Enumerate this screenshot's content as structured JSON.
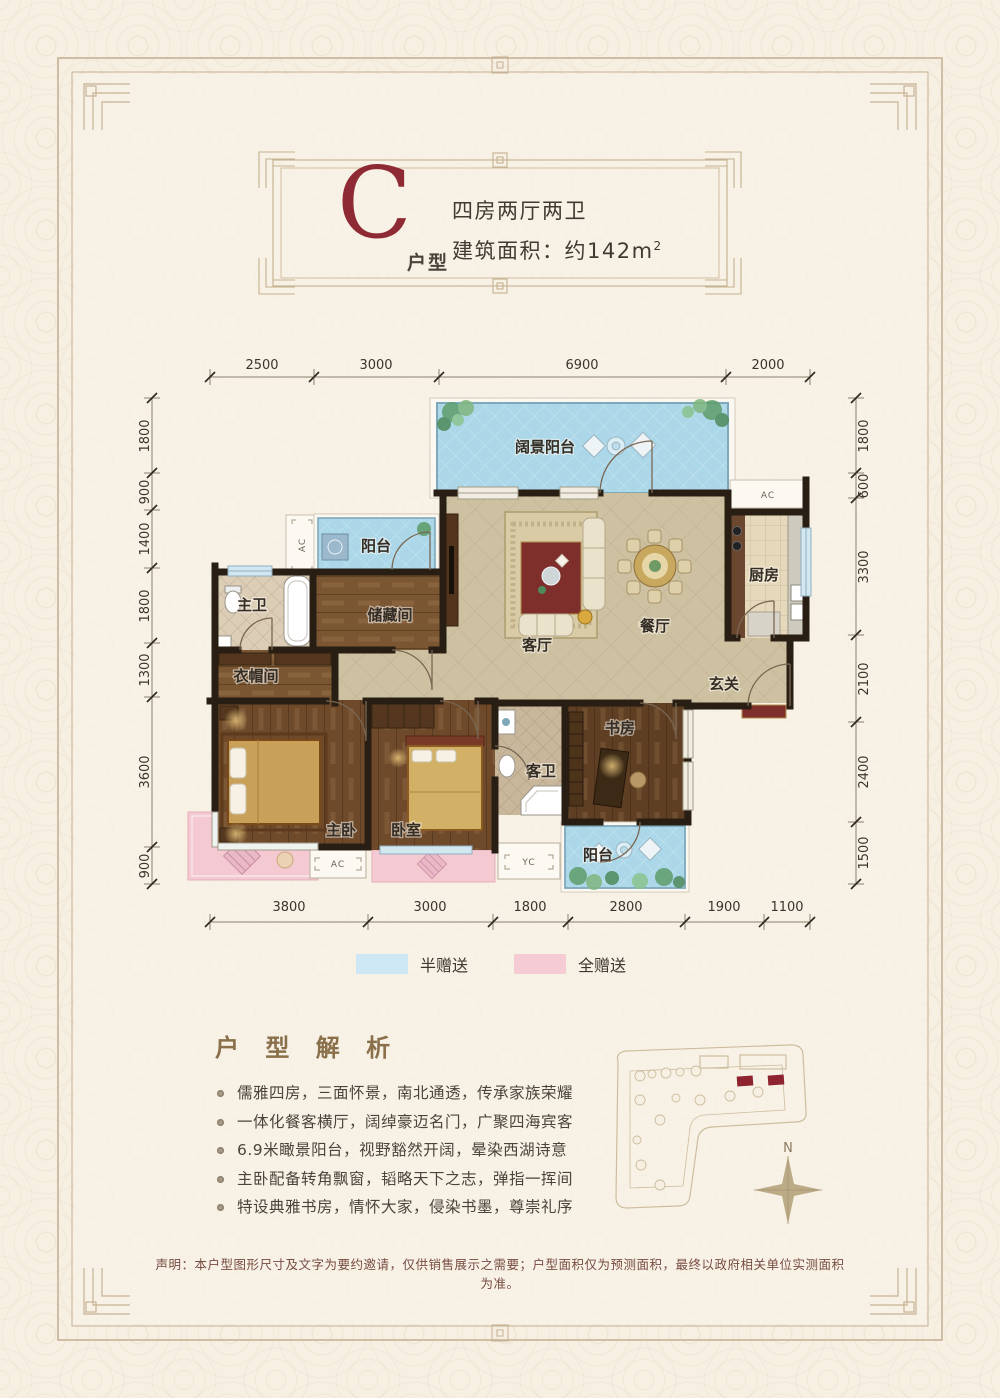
{
  "title": {
    "letter": "C",
    "letter_suffix": "户型",
    "line1": "四房两厅两卫",
    "line2": "建筑面积：约142m",
    "area_sup": "2"
  },
  "dims": {
    "top": [
      "2500",
      "3000",
      "6900",
      "2000"
    ],
    "bottom": [
      "3800",
      "3000",
      "1800",
      "2800",
      "1900",
      "1100"
    ],
    "left": [
      "1800",
      "900",
      "1400",
      "1800",
      "1300",
      "3600",
      "900"
    ],
    "right": [
      "1800",
      "600",
      "3300",
      "2100",
      "2400",
      "1500"
    ]
  },
  "rooms": {
    "view_balcony": "阔景阳台",
    "balcony_top": "阳台",
    "master_bath": "主卫",
    "storage": "储藏间",
    "cloakroom": "衣帽间",
    "living": "客厅",
    "dining": "餐厅",
    "kitchen": "厨房",
    "foyer": "玄关",
    "master_bedroom": "主卧",
    "bedroom": "卧室",
    "guest_bath": "客卫",
    "study": "书房",
    "balcony_bottom": "阳台"
  },
  "ac": [
    "AC",
    "AC",
    "AC",
    "YC"
  ],
  "legend": [
    {
      "label": "半赠送",
      "color": "#cde7f5"
    },
    {
      "label": "全赠送",
      "color": "#f6ccd4"
    }
  ],
  "analysis": {
    "heading": "户 型 解 析",
    "bullets": [
      "儒雅四房，三面怀景，南北通透，传承家族荣耀",
      "一体化餐客横厅，阔绰豪迈名门，广聚四海宾客",
      "6.9米瞰景阳台，视野豁然开阔，晕染西湖诗意",
      "主卧配备转角飘窗，韬略天下之志，弹指一挥间",
      "特设典雅书房，情怀大家，侵染书墨，尊崇礼序"
    ]
  },
  "site": {
    "north": "N"
  },
  "disclaimer": "声明：本户型图形尺寸及文字为要约邀请，仅供销售展示之需要；户型面积仅为预测面积，最终以政府相关单位实测面积为准。",
  "colors": {
    "accent_red": "#8e2a33",
    "wall": "#291e13",
    "floor_tan": "#cdc1a1",
    "balcony_blue": "#abd7e8",
    "gift_pink": "#f4c9d1",
    "wood": "#6e4a2b",
    "frame_tan": "#c7b295"
  }
}
